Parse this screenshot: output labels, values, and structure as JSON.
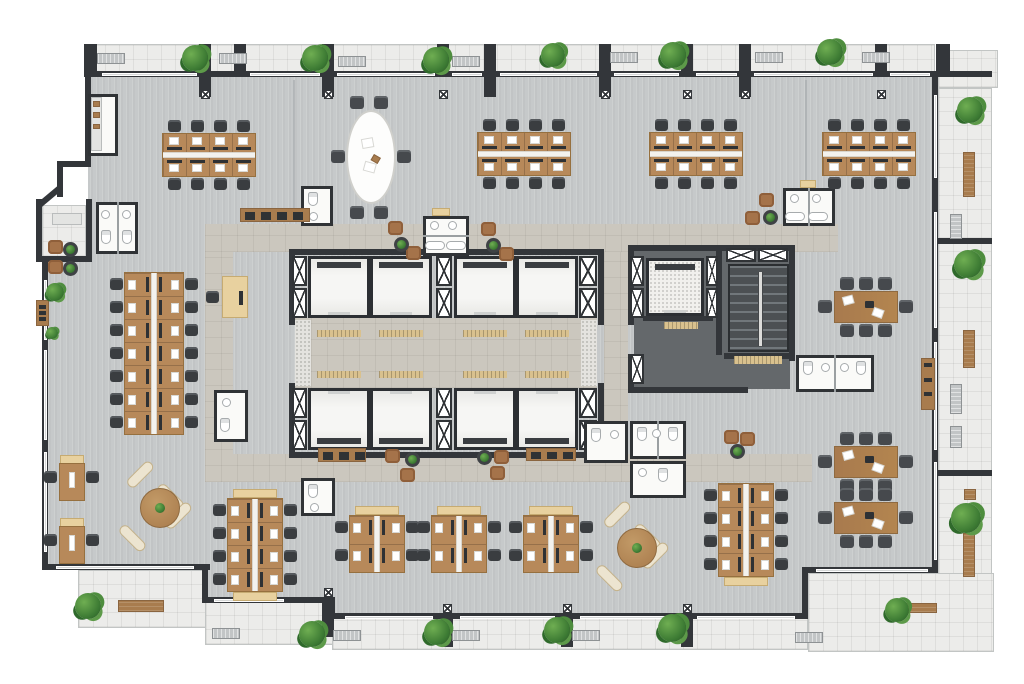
{
  "meta": {
    "kind": "architectural-floor-plan",
    "floor_fill": "#c6c9ca",
    "wall_color": "#33363a",
    "wood_color": "#b7895a",
    "accent_beige": "#e8d19f",
    "plant_green": "#3c7a33"
  },
  "floors": {
    "main": {
      "r": [
        42,
        71,
        896,
        549
      ],
      "poly": "46px 4px, 893px 4px, 893px 499px, 763px 499px, 763px 546px, 290px 546px, 290px 529px, 163px 529px, 163px 496px, 3px 496px, 3px 177px, 46px 135px"
    },
    "balconies": [
      [
        90,
        44,
        845,
        31
      ],
      [
        938,
        50,
        60,
        38
      ],
      [
        938,
        88,
        54,
        487
      ],
      [
        78,
        570,
        128,
        58
      ],
      [
        205,
        601,
        130,
        44
      ],
      [
        332,
        617,
        476,
        33
      ],
      [
        808,
        573,
        186,
        79
      ],
      [
        42,
        205,
        44,
        52
      ]
    ],
    "corridors": [
      [
        205,
        224,
        633,
        28
      ],
      [
        205,
        252,
        28,
        230
      ],
      [
        205,
        454,
        607,
        28
      ],
      [
        604,
        252,
        24,
        202
      ],
      [
        295,
        318,
        302,
        70
      ]
    ],
    "service": [
      [
        634,
        251,
        156,
        138
      ]
    ],
    "stair": [
      728,
      264,
      61,
      88
    ],
    "granites": [
      [
        295,
        320,
        16,
        66
      ],
      [
        581,
        320,
        16,
        66
      ]
    ]
  },
  "walls": [
    [
      88,
      71,
      850,
      6
    ],
    [
      938,
      71,
      54,
      6
    ],
    [
      84,
      44,
      13,
      33
    ],
    [
      936,
      44,
      14,
      33
    ],
    [
      85,
      71,
      6,
      96
    ],
    [
      57,
      161,
      34,
      6
    ],
    [
      57,
      161,
      6,
      36
    ],
    [
      36,
      199,
      6,
      62
    ],
    [
      36,
      256,
      56,
      6
    ],
    [
      86,
      199,
      6,
      60
    ],
    [
      42,
      258,
      6,
      312
    ],
    [
      42,
      564,
      168,
      6
    ],
    [
      202,
      564,
      6,
      39
    ],
    [
      202,
      597,
      133,
      6
    ],
    [
      329,
      597,
      6,
      22
    ],
    [
      329,
      613,
      479,
      6
    ],
    [
      802,
      567,
      6,
      50
    ],
    [
      802,
      567,
      136,
      6
    ],
    [
      932,
      71,
      6,
      502
    ],
    [
      199,
      44,
      12,
      53
    ],
    [
      234,
      44,
      12,
      30
    ],
    [
      322,
      44,
      12,
      53
    ],
    [
      437,
      44,
      12,
      30
    ],
    [
      484,
      44,
      12,
      53
    ],
    [
      599,
      44,
      12,
      53
    ],
    [
      681,
      44,
      12,
      30
    ],
    [
      739,
      44,
      12,
      53
    ],
    [
      875,
      44,
      12,
      30
    ],
    [
      322,
      597,
      12,
      40
    ],
    [
      441,
      613,
      12,
      34
    ],
    [
      561,
      613,
      12,
      34
    ],
    [
      681,
      613,
      12,
      34
    ],
    [
      938,
      238,
      54,
      6
    ],
    [
      938,
      470,
      54,
      6
    ],
    [
      289,
      249,
      315,
      6
    ],
    [
      289,
      452,
      315,
      6
    ],
    [
      289,
      249,
      6,
      76
    ],
    [
      289,
      383,
      6,
      75
    ],
    [
      598,
      249,
      6,
      76
    ],
    [
      598,
      383,
      6,
      75
    ],
    [
      628,
      245,
      167,
      6
    ],
    [
      628,
      245,
      6,
      80
    ],
    [
      628,
      354,
      6,
      39
    ],
    [
      628,
      387,
      120,
      6
    ],
    [
      789,
      245,
      6,
      116
    ],
    [
      724,
      353,
      71,
      6
    ],
    [
      716,
      245,
      6,
      110
    ],
    [
      643,
      316,
      70,
      5
    ]
  ],
  "diag_walls": [
    {
      "x": 36,
      "y": 204,
      "len": 30,
      "rot": -40
    }
  ],
  "windows": [
    [
      102,
      73,
      95,
      3
    ],
    [
      250,
      73,
      70,
      3
    ],
    [
      337,
      73,
      98,
      3
    ],
    [
      452,
      73,
      30,
      3
    ],
    [
      500,
      73,
      97,
      3
    ],
    [
      614,
      73,
      65,
      3
    ],
    [
      696,
      73,
      41,
      3
    ],
    [
      754,
      73,
      119,
      3
    ],
    [
      890,
      73,
      40,
      3
    ],
    [
      44,
      280,
      3,
      60
    ],
    [
      44,
      350,
      3,
      90
    ],
    [
      44,
      452,
      3,
      100
    ],
    [
      934,
      95,
      3,
      83
    ],
    [
      934,
      212,
      3,
      116
    ],
    [
      934,
      342,
      3,
      108
    ],
    [
      934,
      462,
      3,
      98
    ],
    [
      214,
      599,
      70,
      3
    ],
    [
      345,
      616,
      88,
      3
    ],
    [
      460,
      616,
      95,
      3
    ],
    [
      580,
      616,
      95,
      3
    ],
    [
      697,
      616,
      98,
      3
    ],
    [
      816,
      569,
      112,
      3
    ],
    [
      56,
      566,
      138,
      3
    ]
  ],
  "glass": [
    [
      293,
      80,
      2,
      142
    ],
    [
      805,
      80,
      2,
      100
    ]
  ],
  "core": {
    "car_size": 62,
    "cars": [
      {
        "x": 308,
        "y": 256,
        "door": "b"
      },
      {
        "x": 370,
        "y": 256,
        "door": "b"
      },
      {
        "x": 454,
        "y": 256,
        "door": "b"
      },
      {
        "x": 516,
        "y": 256,
        "door": "b"
      },
      {
        "x": 308,
        "y": 388,
        "door": "t"
      },
      {
        "x": 370,
        "y": 388,
        "door": "t"
      },
      {
        "x": 454,
        "y": 388,
        "door": "t"
      },
      {
        "x": 516,
        "y": 388,
        "door": "t"
      }
    ],
    "service_car": [
      646,
      258,
      58,
      58
    ],
    "shafts": [
      [
        292,
        256,
        15,
        30
      ],
      [
        292,
        288,
        15,
        30
      ],
      [
        436,
        256,
        16,
        30
      ],
      [
        436,
        288,
        16,
        30
      ],
      [
        579,
        256,
        18,
        30
      ],
      [
        579,
        288,
        18,
        30
      ],
      [
        292,
        388,
        15,
        30
      ],
      [
        292,
        420,
        15,
        30
      ],
      [
        436,
        388,
        16,
        30
      ],
      [
        436,
        420,
        16,
        30
      ],
      [
        579,
        388,
        18,
        30
      ],
      [
        579,
        420,
        18,
        30
      ],
      [
        630,
        256,
        14,
        30
      ],
      [
        630,
        288,
        14,
        30
      ],
      [
        706,
        256,
        12,
        30
      ],
      [
        706,
        288,
        12,
        30
      ],
      [
        726,
        248,
        30,
        14
      ],
      [
        758,
        248,
        30,
        14
      ],
      [
        630,
        354,
        14,
        30
      ]
    ],
    "mats": [
      [
        317,
        330,
        44,
        7
      ],
      [
        379,
        330,
        44,
        7
      ],
      [
        463,
        330,
        44,
        7
      ],
      [
        525,
        330,
        44,
        7
      ],
      [
        317,
        371,
        44,
        7
      ],
      [
        379,
        371,
        44,
        7
      ],
      [
        463,
        371,
        44,
        7
      ],
      [
        525,
        371,
        44,
        7
      ],
      [
        664,
        322,
        34,
        7
      ],
      [
        734,
        356,
        48,
        8
      ]
    ]
  },
  "rooms": [
    {
      "r": [
        96,
        202,
        42,
        52
      ],
      "div": [
        [
          117,
          202,
          2,
          52
        ]
      ],
      "fx": [
        [
          "sink",
          101,
          210
        ],
        [
          "sink",
          122,
          210
        ],
        [
          "toilet",
          101,
          230
        ],
        [
          "toilet",
          122,
          230
        ]
      ]
    },
    {
      "r": [
        214,
        390,
        34,
        52
      ],
      "div": [],
      "fx": [
        [
          "sink",
          222,
          398
        ],
        [
          "toilet",
          220,
          418
        ]
      ]
    },
    {
      "r": [
        423,
        216,
        46,
        40
      ],
      "div": [
        [
          423,
          235,
          46,
          2
        ]
      ],
      "fx": [
        [
          "sink",
          430,
          221
        ],
        [
          "sink",
          448,
          221
        ],
        [
          "tub",
          425,
          241
        ],
        [
          "tub",
          446,
          241
        ]
      ]
    },
    {
      "r": [
        783,
        188,
        52,
        38
      ],
      "div": [
        [
          808,
          188,
          2,
          38
        ]
      ],
      "fx": [
        [
          "sink",
          790,
          194
        ],
        [
          "sink",
          812,
          194
        ],
        [
          "tub",
          785,
          212
        ],
        [
          "tub",
          808,
          212
        ]
      ]
    },
    {
      "r": [
        301,
        478,
        34,
        38
      ],
      "div": [],
      "fx": [
        [
          "toilet",
          308,
          484
        ],
        [
          "sink",
          310,
          503
        ]
      ]
    },
    {
      "r": [
        584,
        421,
        44,
        42
      ],
      "div": [],
      "fx": [
        [
          "toilet",
          591,
          428
        ],
        [
          "sink",
          610,
          430
        ]
      ]
    },
    {
      "r": [
        630,
        421,
        56,
        38
      ],
      "div": [
        [
          657,
          421,
          2,
          38
        ]
      ],
      "fx": [
        [
          "toilet",
          637,
          427
        ],
        [
          "sink",
          652,
          429
        ],
        [
          "toilet",
          668,
          427
        ]
      ]
    },
    {
      "r": [
        630,
        461,
        56,
        37
      ],
      "div": [],
      "fx": [
        [
          "sink",
          638,
          468
        ],
        [
          "toilet",
          658,
          468
        ]
      ]
    },
    {
      "r": [
        796,
        355,
        78,
        37
      ],
      "div": [
        [
          834,
          355,
          2,
          37
        ]
      ],
      "fx": [
        [
          "toilet",
          803,
          361
        ],
        [
          "sink",
          821,
          363
        ],
        [
          "sink",
          840,
          363
        ],
        [
          "toilet",
          856,
          361
        ]
      ]
    },
    {
      "r": [
        301,
        186,
        32,
        40
      ],
      "div": [],
      "fx": [
        [
          "toilet",
          308,
          192
        ],
        [
          "sink",
          309,
          212
        ]
      ]
    },
    {
      "r": [
        88,
        94,
        30,
        62
      ],
      "div": [],
      "fx": []
    }
  ],
  "counters": [
    [
      91,
      97,
      11,
      54
    ],
    [
      52,
      213,
      30,
      12
    ]
  ],
  "counter_items": [
    [
      93,
      101,
      7,
      6
    ],
    [
      93,
      112,
      7,
      6
    ],
    [
      93,
      124,
      7,
      5
    ]
  ],
  "caddies": [
    [
      432,
      208,
      18,
      8
    ],
    [
      800,
      180,
      16,
      8
    ]
  ],
  "furniture": {
    "banks": [
      {
        "o": "h",
        "u": 4,
        "x": 163,
        "y": 134,
        "d": 18
      },
      {
        "o": "h",
        "u": 4,
        "x": 478,
        "y": 133,
        "d": 18
      },
      {
        "o": "h",
        "u": 4,
        "x": 650,
        "y": 133,
        "d": 18
      },
      {
        "o": "h",
        "u": 4,
        "x": 823,
        "y": 133,
        "d": 18
      },
      {
        "o": "v",
        "u": 7,
        "x": 125,
        "y": 273,
        "d": 26
      },
      {
        "o": "v",
        "u": 4,
        "x": 228,
        "y": 499,
        "d": 24,
        "cap": "both"
      },
      {
        "o": "v",
        "u": 4,
        "x": 719,
        "y": 484,
        "d": 24,
        "cap": "end"
      },
      {
        "o": "v",
        "u": 2,
        "x": 350,
        "y": 516,
        "d": 24,
        "L": 28,
        "cap": "start"
      },
      {
        "o": "v",
        "u": 2,
        "x": 432,
        "y": 516,
        "d": 24,
        "L": 28,
        "cap": "start"
      },
      {
        "o": "v",
        "u": 2,
        "x": 524,
        "y": 516,
        "d": 24,
        "L": 28,
        "cap": "start"
      }
    ],
    "meetings": [
      [
        835,
        292
      ],
      [
        835,
        447
      ],
      [
        835,
        503
      ]
    ],
    "rounds": [
      [
        160,
        508
      ],
      [
        637,
        548
      ]
    ],
    "oval": [
      346,
      110,
      50,
      94
    ],
    "singles": [
      [
        60,
        455
      ],
      [
        60,
        518
      ]
    ],
    "reception": [
      222,
      276
    ],
    "credenzas": [
      [
        240,
        208,
        70,
        14
      ],
      [
        318,
        448,
        48,
        14
      ],
      [
        526,
        448,
        50,
        13
      ]
    ],
    "shelves": [
      [
        921,
        358,
        14,
        52
      ],
      [
        36,
        300,
        13,
        26
      ]
    ],
    "armchairs": [
      [
        388,
        221
      ],
      [
        406,
        246
      ],
      [
        481,
        222
      ],
      [
        499,
        247
      ],
      [
        759,
        193
      ],
      [
        745,
        211
      ],
      [
        385,
        449
      ],
      [
        400,
        468
      ],
      [
        494,
        450
      ],
      [
        490,
        466
      ],
      [
        724,
        430
      ],
      [
        740,
        432
      ],
      [
        48,
        240
      ],
      [
        48,
        260
      ]
    ],
    "side_tables": [
      [
        394,
        237
      ],
      [
        486,
        238
      ],
      [
        763,
        210
      ],
      [
        405,
        452
      ],
      [
        477,
        450
      ],
      [
        730,
        444
      ],
      [
        63,
        242
      ],
      [
        63,
        261
      ]
    ]
  },
  "outdoor": {
    "plants": [
      [
        195,
        58,
        26
      ],
      [
        315,
        58,
        26
      ],
      [
        436,
        60,
        26
      ],
      [
        553,
        55,
        24
      ],
      [
        673,
        55,
        26
      ],
      [
        830,
        52,
        26
      ],
      [
        970,
        110,
        26
      ],
      [
        968,
        264,
        28
      ],
      [
        966,
        518,
        30
      ],
      [
        312,
        634,
        26
      ],
      [
        437,
        632,
        26
      ],
      [
        557,
        630,
        26
      ],
      [
        672,
        628,
        28
      ],
      [
        897,
        610,
        24
      ],
      [
        88,
        606,
        26
      ],
      [
        55,
        292,
        18
      ],
      [
        52,
        333,
        12
      ]
    ],
    "benches": [
      [
        118,
        600,
        46,
        12
      ],
      [
        895,
        603,
        42,
        10
      ],
      [
        963,
        152,
        12,
        45
      ],
      [
        963,
        330,
        12,
        38
      ],
      [
        963,
        533,
        12,
        44
      ],
      [
        964,
        489,
        12,
        11
      ]
    ],
    "hvac": [
      [
        97,
        53,
        28,
        11
      ],
      [
        219,
        53,
        28,
        11
      ],
      [
        338,
        56,
        28,
        11
      ],
      [
        452,
        56,
        28,
        11
      ],
      [
        610,
        52,
        28,
        11
      ],
      [
        755,
        52,
        28,
        11
      ],
      [
        862,
        52,
        28,
        11
      ],
      [
        212,
        628,
        28,
        11
      ],
      [
        333,
        630,
        28,
        11
      ],
      [
        452,
        630,
        28,
        11
      ],
      [
        572,
        630,
        28,
        11
      ],
      [
        795,
        632,
        28,
        11
      ],
      [
        950,
        214,
        12,
        25
      ],
      [
        950,
        384,
        12,
        30
      ],
      [
        950,
        426,
        12,
        22
      ]
    ],
    "xboxes": [
      [
        201,
        90
      ],
      [
        324,
        90
      ],
      [
        439,
        90
      ],
      [
        601,
        90
      ],
      [
        683,
        90
      ],
      [
        741,
        90
      ],
      [
        877,
        90
      ],
      [
        324,
        588
      ],
      [
        443,
        604
      ],
      [
        563,
        604
      ],
      [
        683,
        604
      ]
    ]
  }
}
